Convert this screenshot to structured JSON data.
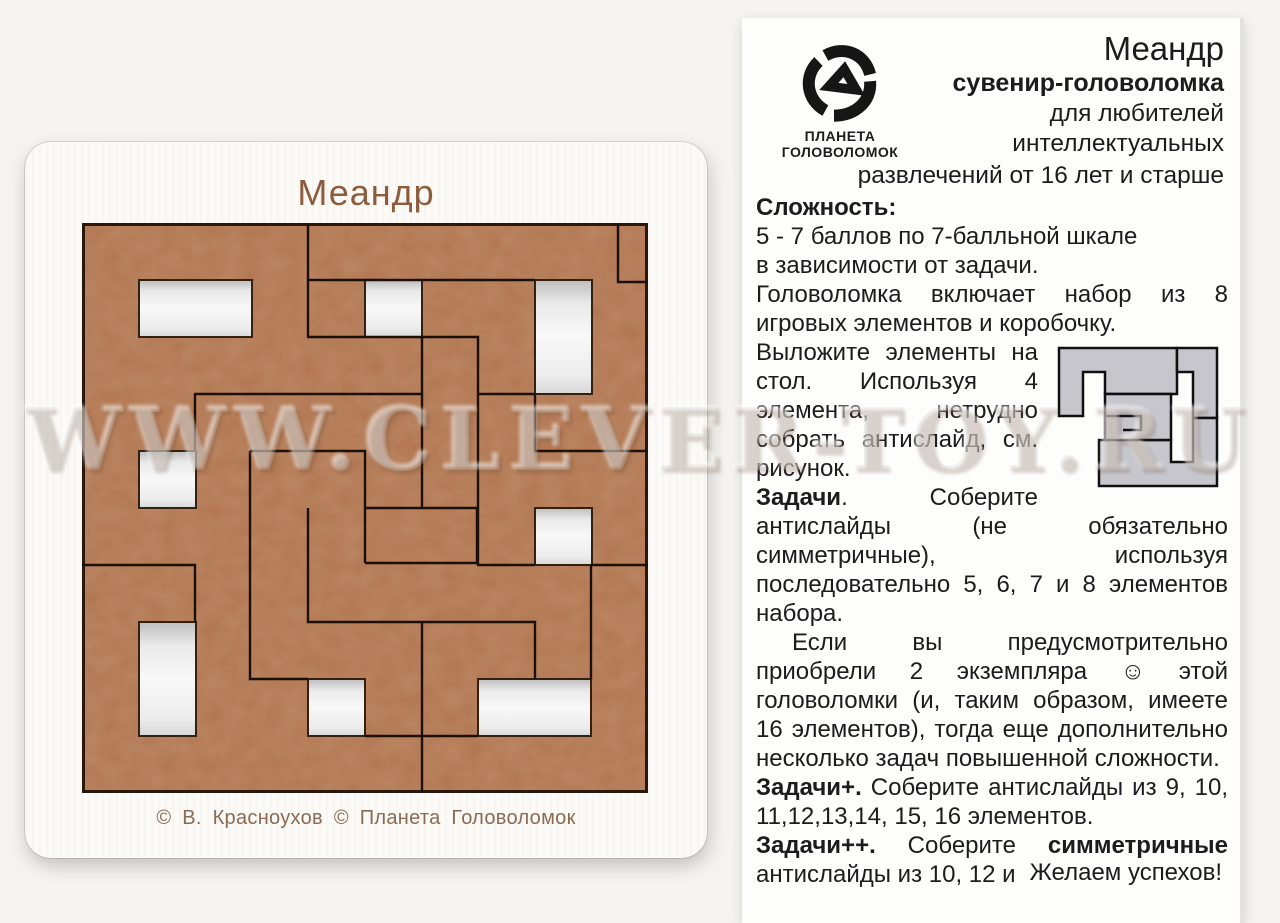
{
  "watermark": {
    "text": "WWW.CLEVER-TOY.RU"
  },
  "colors": {
    "wood": "#b2744e",
    "board_white": "#fbfaf7",
    "etched_text": "#8d5c3c",
    "paper": "#fdfdfc",
    "ink": "#1c1c1e",
    "diagram_gray": "#c6c6cc"
  },
  "board": {
    "title": "Меандр",
    "copyright": "© В. Красноухов  © Планета  Головоломок"
  },
  "leaflet": {
    "brand": {
      "line1": "ПЛАНЕТА",
      "line2": "ГОЛОВОЛОМОК",
      "icon": "knot-logo"
    },
    "title": "Меандр",
    "subtitle": "сувенир-головоломка",
    "audience": [
      "для любителей",
      "интеллектуальных",
      "развлечений от 16 лет и старше"
    ],
    "difficulty_heading": "Сложность:",
    "difficulty_line1": "5 - 7 баллов по 7-балльной шкале",
    "difficulty_line2": "в зависимости от задачи.",
    "includes": "Головоломка включает набор из 8 игровых элементов и коробочку.",
    "layout_hint": "Выложите элементы на стол. Используя 4 элемента, нетрудно собрать антислайд, см. рисунок.",
    "tasks_heading": "Задачи",
    "tasks_body": ". Соберите антислайды (не обязательно симметричные), используя последовательно 5, 6, 7 и 8 элементов набора.",
    "bonus_note": "Если вы предусмотрительно приобрели 2 экземпляра ☺ этой головоломки (и, таким образом, имеете 16 элементов), тогда еще дополнительно несколько задач повышенной сложности.",
    "tasks_plus_heading": "Задачи+.",
    "tasks_plus_body": " Соберите антислайды из 9, 10, 11,12,13,14, 15, 16 элементов.",
    "tasks_pp_heading": "Задачи++.",
    "tasks_pp_body1": " Соберите ",
    "tasks_pp_bold": "симметричные",
    "tasks_pp_body2": " антислайды из 10, 12 и 16 элементов.",
    "farewell": "Желаем успехов!"
  }
}
